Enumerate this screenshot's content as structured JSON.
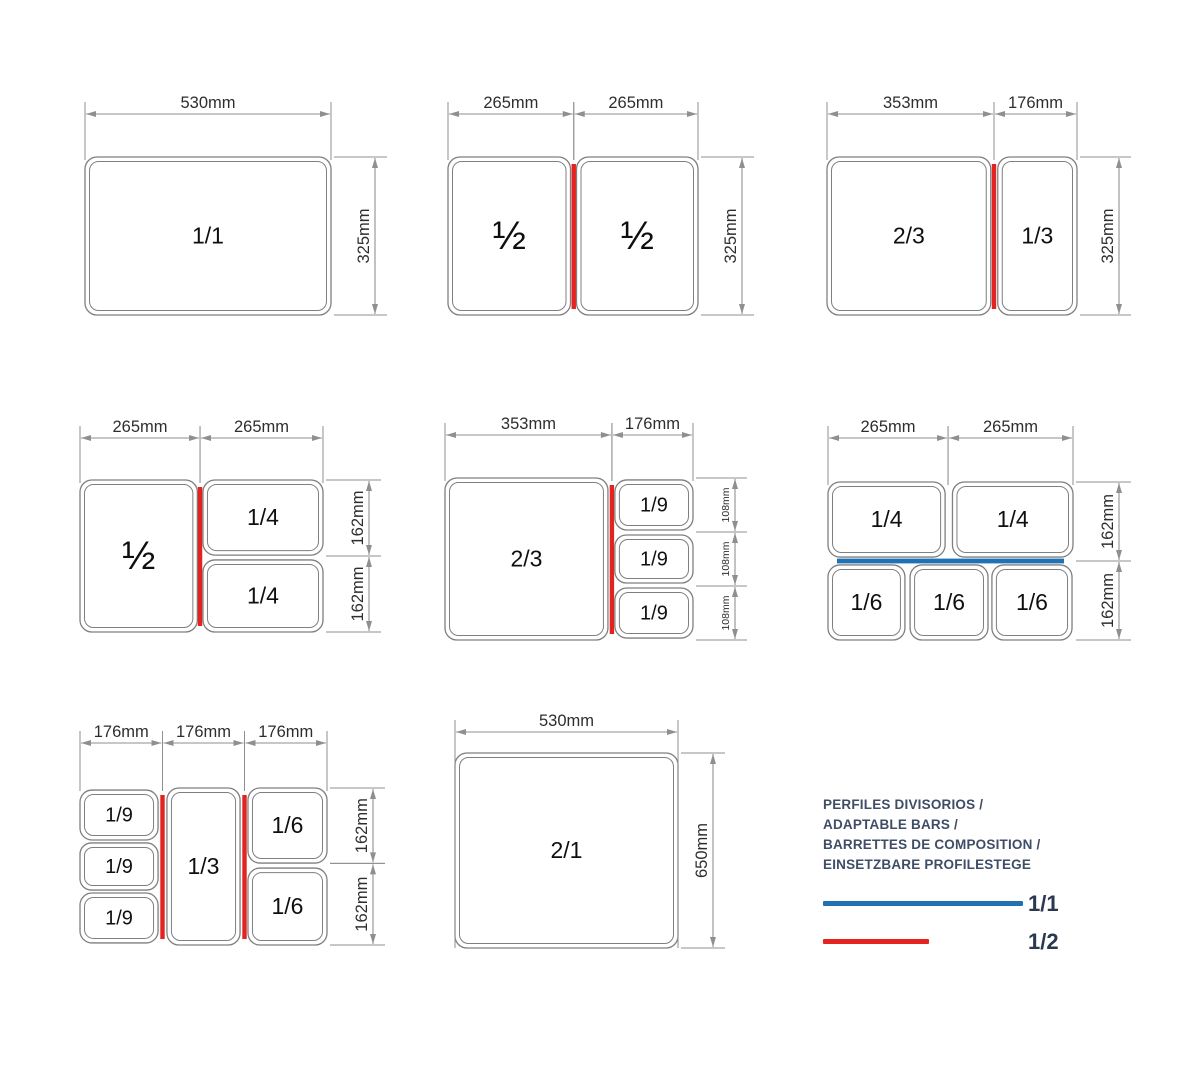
{
  "colors": {
    "background": "#ffffff",
    "red": "#e42320",
    "blue": "#2172b2",
    "pan_line": "#7f7f7f",
    "pan_text": "#0f0f0f",
    "dim_line": "#8f8f8f",
    "dim_text": "#2e2e2e",
    "legend_text": "#3f4d66",
    "legend_label": "#2b3950"
  },
  "legend": {
    "title_lines": [
      "PERFILES DIVISORIOS /",
      "ADAPTABLE BARS /",
      "BARRETTES DE COMPOSITION /",
      "EINSETZBARE PROFILESTEGE"
    ],
    "entries": [
      {
        "label": "1/1",
        "color": "#2172b2",
        "bar_w": 200
      },
      {
        "label": "1/2",
        "color": "#e42320",
        "bar_w": 106
      }
    ]
  },
  "diagrams": [
    {
      "id": "gn-1-1",
      "frame": {
        "x": 85,
        "y": 157,
        "w": 246,
        "h": 158
      },
      "top_off": 43,
      "side_off": 44,
      "pans": [
        {
          "x": 0,
          "y": 0,
          "w": 1,
          "h": 1,
          "label": "1/1"
        }
      ],
      "dividers": [],
      "top_dims": [
        {
          "from": 0,
          "to": 1,
          "label": "530mm"
        }
      ],
      "side_dims": [
        {
          "from": 0,
          "to": 1,
          "label": "325mm"
        }
      ]
    },
    {
      "id": "gn-half-half",
      "frame": {
        "x": 448,
        "y": 157,
        "w": 250,
        "h": 158
      },
      "top_off": 43,
      "side_off": 44,
      "pans": [
        {
          "x": 0,
          "y": 0,
          "w": 0.49,
          "h": 1,
          "label": "½",
          "fs": 40
        },
        {
          "x": 0.514,
          "y": 0,
          "w": 0.486,
          "h": 1,
          "label": "½",
          "fs": 40
        }
      ],
      "dividers": [
        {
          "dir": "v",
          "pos": 0.503,
          "color": "red"
        }
      ],
      "top_dims": [
        {
          "from": 0,
          "to": 0.503,
          "label": "265mm"
        },
        {
          "from": 0.503,
          "to": 1,
          "label": "265mm"
        }
      ],
      "side_dims": [
        {
          "from": 0,
          "to": 1,
          "label": "325mm"
        }
      ]
    },
    {
      "id": "gn-twothirds-third",
      "frame": {
        "x": 827,
        "y": 157,
        "w": 250,
        "h": 158
      },
      "top_off": 43,
      "side_off": 42,
      "pans": [
        {
          "x": 0,
          "y": 0,
          "w": 0.655,
          "h": 1,
          "label": "2/3"
        },
        {
          "x": 0.683,
          "y": 0,
          "w": 0.317,
          "h": 1,
          "label": "1/3"
        }
      ],
      "dividers": [
        {
          "dir": "v",
          "pos": 0.668,
          "color": "red"
        }
      ],
      "top_dims": [
        {
          "from": 0,
          "to": 0.668,
          "label": "353mm"
        },
        {
          "from": 0.668,
          "to": 1,
          "label": "176mm"
        }
      ],
      "side_dims": [
        {
          "from": 0,
          "to": 1,
          "label": "325mm"
        }
      ]
    },
    {
      "id": "gn-half-quarters",
      "frame": {
        "x": 80,
        "y": 480,
        "w": 243,
        "h": 152
      },
      "top_off": 42,
      "side_off": 46,
      "pans": [
        {
          "x": 0,
          "y": 0,
          "w": 0.483,
          "h": 1,
          "label": "½",
          "fs": 40
        },
        {
          "x": 0.506,
          "y": 0,
          "w": 0.494,
          "h": 0.494,
          "label": "1/4"
        },
        {
          "x": 0.506,
          "y": 0.526,
          "w": 0.494,
          "h": 0.474,
          "label": "1/4"
        }
      ],
      "dividers": [
        {
          "dir": "v",
          "pos": 0.494,
          "color": "red"
        }
      ],
      "top_dims": [
        {
          "from": 0,
          "to": 0.494,
          "label": "265mm"
        },
        {
          "from": 0.494,
          "to": 1,
          "label": "265mm"
        }
      ],
      "side_dims": [
        {
          "from": 0,
          "to": 0.5,
          "label": "162mm"
        },
        {
          "from": 0.5,
          "to": 1,
          "label": "162mm"
        }
      ]
    },
    {
      "id": "gn-twothirds-ninths",
      "frame": {
        "x": 445,
        "y": 478,
        "w": 248,
        "h": 162
      },
      "top_off": 43,
      "side_off": 42,
      "pans": [
        {
          "x": 0,
          "y": 0,
          "w": 0.657,
          "h": 1,
          "label": "2/3"
        },
        {
          "x": 0.685,
          "y": 0.012,
          "w": 0.315,
          "h": 0.309,
          "label": "1/9",
          "fs": 20
        },
        {
          "x": 0.685,
          "y": 0.352,
          "w": 0.315,
          "h": 0.296,
          "label": "1/9",
          "fs": 20
        },
        {
          "x": 0.685,
          "y": 0.679,
          "w": 0.315,
          "h": 0.309,
          "label": "1/9",
          "fs": 20
        }
      ],
      "dividers": [
        {
          "dir": "v",
          "pos": 0.673,
          "color": "red"
        }
      ],
      "top_dims": [
        {
          "from": 0,
          "to": 0.673,
          "label": "353mm"
        },
        {
          "from": 0.673,
          "to": 1,
          "label": "176mm"
        }
      ],
      "side_dims": [
        {
          "from": 0,
          "to": 0.333,
          "label": "108mm",
          "small": true
        },
        {
          "from": 0.333,
          "to": 0.667,
          "label": "108mm",
          "small": true
        },
        {
          "from": 0.667,
          "to": 1,
          "label": "108mm",
          "small": true
        }
      ]
    },
    {
      "id": "gn-quarters-sixths",
      "frame": {
        "x": 828,
        "y": 482,
        "w": 245,
        "h": 158
      },
      "top_off": 44,
      "side_off": 46,
      "pans": [
        {
          "x": 0,
          "y": 0,
          "w": 0.478,
          "h": 0.475,
          "label": "1/4"
        },
        {
          "x": 0.508,
          "y": 0,
          "w": 0.492,
          "h": 0.475,
          "label": "1/4"
        },
        {
          "x": 0,
          "y": 0.525,
          "w": 0.314,
          "h": 0.475,
          "label": "1/6"
        },
        {
          "x": 0.335,
          "y": 0.525,
          "w": 0.318,
          "h": 0.475,
          "label": "1/6"
        },
        {
          "x": 0.669,
          "y": 0.525,
          "w": 0.327,
          "h": 0.475,
          "label": "1/6"
        }
      ],
      "dividers": [
        {
          "dir": "h",
          "pos": 0.5,
          "color": "blue"
        }
      ],
      "top_dims": [
        {
          "from": 0,
          "to": 0.49,
          "label": "265mm"
        },
        {
          "from": 0.49,
          "to": 1,
          "label": "265mm"
        }
      ],
      "side_dims": [
        {
          "from": 0,
          "to": 0.5,
          "label": "162mm"
        },
        {
          "from": 0.5,
          "to": 1,
          "label": "162mm"
        }
      ]
    },
    {
      "id": "gn-ninths-third-sixths",
      "frame": {
        "x": 80,
        "y": 788,
        "w": 247,
        "h": 157
      },
      "top_off": 45,
      "side_off": 46,
      "pans": [
        {
          "x": 0,
          "y": 0.013,
          "w": 0.316,
          "h": 0.318,
          "label": "1/9",
          "fs": 20
        },
        {
          "x": 0,
          "y": 0.35,
          "w": 0.316,
          "h": 0.3,
          "label": "1/9",
          "fs": 20
        },
        {
          "x": 0,
          "y": 0.669,
          "w": 0.316,
          "h": 0.318,
          "label": "1/9",
          "fs": 20
        },
        {
          "x": 0.352,
          "y": 0,
          "w": 0.296,
          "h": 1,
          "label": "1/3"
        },
        {
          "x": 0.68,
          "y": 0,
          "w": 0.32,
          "h": 0.478,
          "label": "1/6"
        },
        {
          "x": 0.68,
          "y": 0.51,
          "w": 0.32,
          "h": 0.49,
          "label": "1/6"
        }
      ],
      "dividers": [
        {
          "dir": "v",
          "pos": 0.334,
          "color": "red"
        },
        {
          "dir": "v",
          "pos": 0.666,
          "color": "red"
        }
      ],
      "top_dims": [
        {
          "from": 0,
          "to": 0.334,
          "label": "176mm"
        },
        {
          "from": 0.334,
          "to": 0.666,
          "label": "176mm"
        },
        {
          "from": 0.666,
          "to": 1,
          "label": "176mm"
        }
      ],
      "side_dims": [
        {
          "from": 0,
          "to": 0.48,
          "label": "162mm"
        },
        {
          "from": 0.48,
          "to": 1,
          "label": "162mm"
        }
      ]
    },
    {
      "id": "gn-2-1",
      "frame": {
        "x": 455,
        "y": 753,
        "w": 223,
        "h": 195
      },
      "top_off": 21,
      "side_off": 35,
      "ext_full": true,
      "pans": [
        {
          "x": 0,
          "y": 0,
          "w": 1,
          "h": 1,
          "label": "2/1"
        }
      ],
      "dividers": [],
      "top_dims": [
        {
          "from": 0,
          "to": 1,
          "label": "530mm"
        }
      ],
      "side_dims": [
        {
          "from": 0,
          "to": 1,
          "label": "650mm"
        }
      ]
    }
  ]
}
